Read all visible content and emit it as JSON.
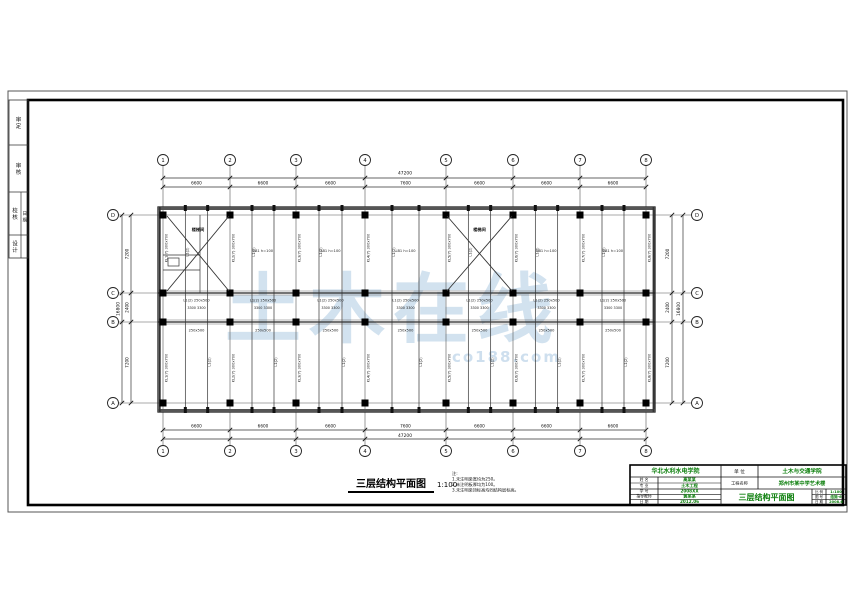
{
  "watermark": {
    "text": "土木在线",
    "subtext": "co188.com"
  },
  "caption": {
    "title": "三层结构平面图",
    "scale": "1:100",
    "notes": [
      "注:",
      "1.未注明梁宽均为250。",
      "2.未注明板厚均为100。",
      "3.未注明梁顶标高均同结构层标高。"
    ]
  },
  "side_strip": {
    "cells": [
      "审 定",
      "审 核",
      "校 核",
      "设 计"
    ],
    "sub_cell": "日 期"
  },
  "plan": {
    "col_ids": [
      "1",
      "2",
      "3",
      "4",
      "5",
      "6",
      "7",
      "8"
    ],
    "row_ids": [
      "D",
      "C",
      "B",
      "A"
    ],
    "top_dims": [
      "6600",
      "6600",
      "6600",
      "7600",
      "6600",
      "6600",
      "6600"
    ],
    "bottom_dims": [
      "6600",
      "6600",
      "6600",
      "7600",
      "6600",
      "6600",
      "6600"
    ],
    "left_dims": [
      "7200",
      "2400",
      "7200"
    ],
    "right_dims": [
      "7200",
      "2400",
      "7200"
    ],
    "total_width": "47200",
    "total_height": "16800",
    "stair_label": "楼梯间",
    "beam_labels_v": [
      "KL1(7) 300x700",
      "KL2(7) 300x700",
      "KL3(7) 300x700",
      "KL4(7) 300x700",
      "KL5(7) 300x700",
      "KL6(7) 300x700",
      "KL7(7) 300x700",
      "KL8(7) 300x700"
    ],
    "sec_beam_label": "L1(2)",
    "beam_label_h": "L1(2) 250x500",
    "beam_label_small": "250x500",
    "slab_label": "LB1 h=100",
    "bay_half_dim": "3300"
  },
  "titleblock": {
    "school": "华北水利水电学院",
    "unit_label": "单 位",
    "unit_value": "土木与交通学院",
    "project_label": "工程名称",
    "project_value": "郑州市某中学艺术楼",
    "drawing_title": "三层结构平面图",
    "info_rows": [
      [
        "姓 名",
        "高某某"
      ],
      [
        "专 业",
        "土木工程"
      ],
      [
        "学 号",
        "2008XX"
      ],
      [
        "指导教师",
        "黄某某"
      ],
      [
        "日 期",
        "2012.06"
      ]
    ],
    "meta_rows": [
      [
        "比 例",
        "1:100"
      ],
      [
        "图 号",
        "结施-6"
      ],
      [
        "日 期",
        "2008.6"
      ]
    ]
  },
  "colors": {
    "line": "#1a1a1a",
    "green": "#0b7e0b",
    "watermark": "#adcae2"
  }
}
